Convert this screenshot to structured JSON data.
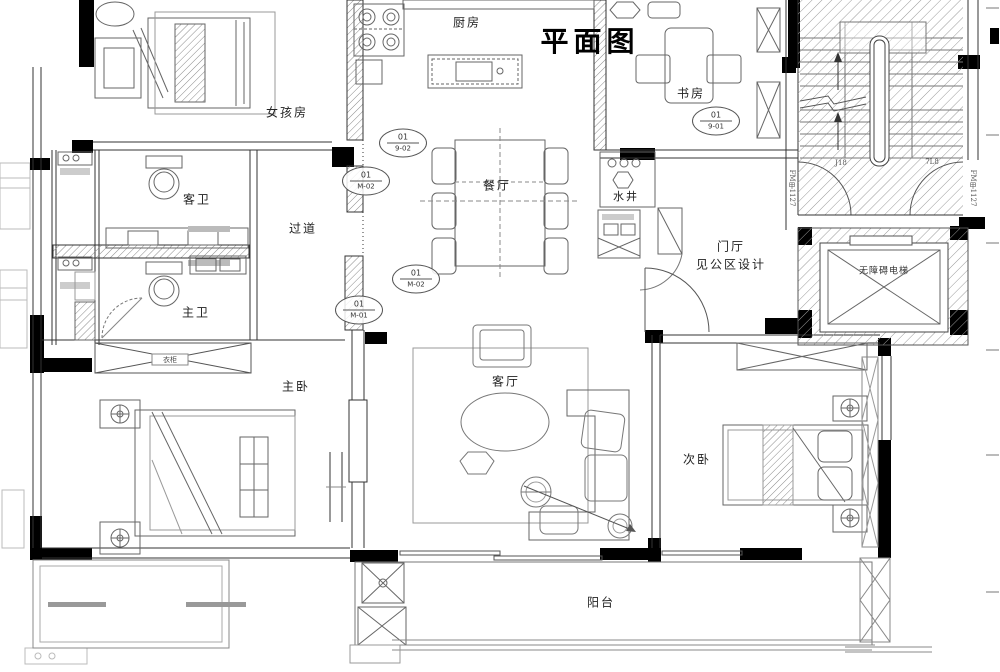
{
  "title": "平面图",
  "rooms": {
    "kitchen": "厨房",
    "girls_room": "女孩房",
    "study": "书房",
    "guest_bath": "客卫",
    "hallway": "过道",
    "dining": "餐厅",
    "water_shaft": "水井",
    "foyer": "门厅",
    "foyer_note": "见公区设计",
    "elevator": "无障碍电梯",
    "master_bath": "主卫",
    "master_bedroom": "主卧",
    "living_room": "客厅",
    "second_bedroom": "次卧",
    "balcony": "阳台",
    "wardrobe": "衣柜"
  },
  "markers": [
    {
      "top": "01",
      "bottom": "9-02"
    },
    {
      "top": "01",
      "bottom": "M-02"
    },
    {
      "top": "01",
      "bottom": "M-02"
    },
    {
      "top": "01",
      "bottom": "M-01"
    },
    {
      "top": "01",
      "bottom": "9-01"
    }
  ],
  "annotations": {
    "stair_left": "J18",
    "stair_right": "7L8",
    "door_tag_left": "FM甲1127",
    "door_tag_right": "FM甲1127"
  },
  "colors": {
    "wall": "#000000",
    "line": "#555555",
    "hatch": "#9a9a9a",
    "label": "#222222"
  }
}
